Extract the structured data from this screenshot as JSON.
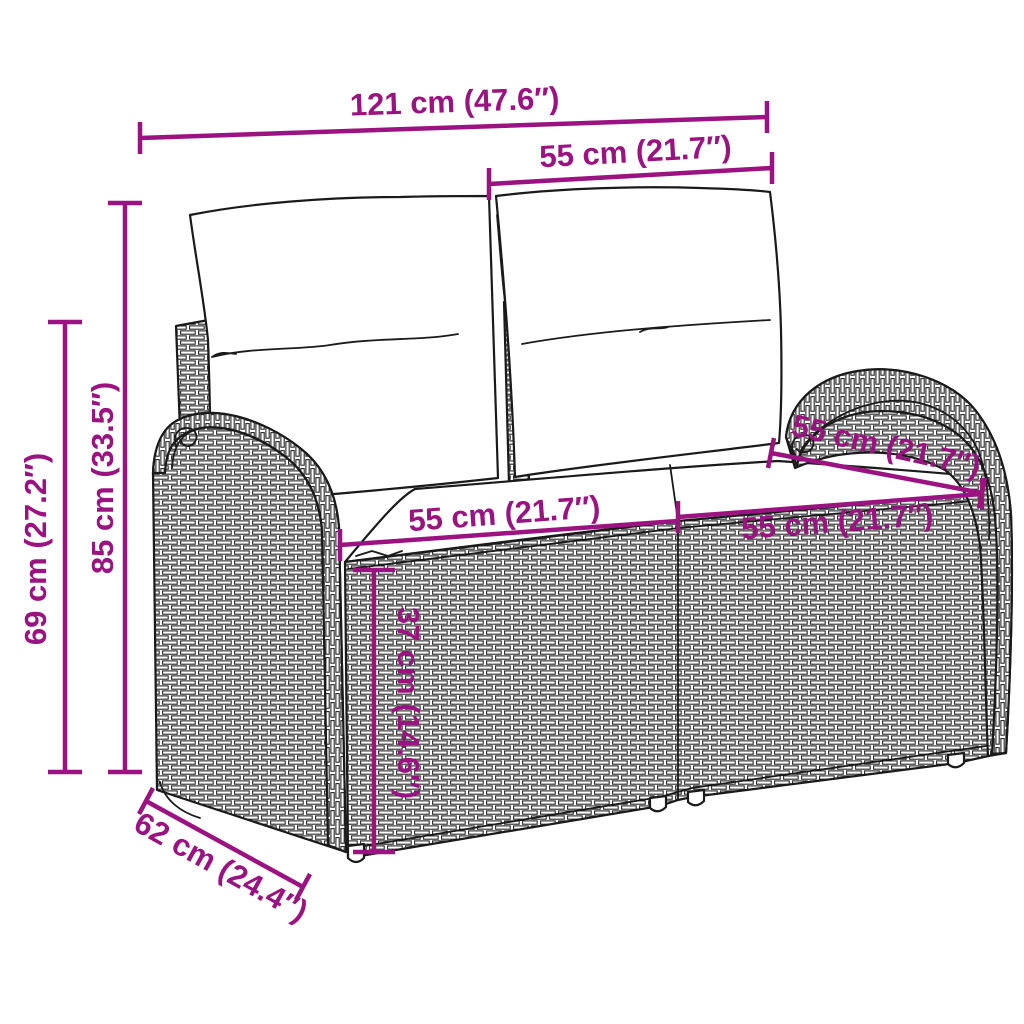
{
  "page": {
    "background": "#ffffff"
  },
  "diagram": {
    "subject": "poly-rattan-two-seater-garden-bench-with-cushions",
    "accent_color": "#9b1380",
    "line_color": "#1a1a1a",
    "dims": {
      "total_width": {
        "label": "121 cm (47.6″)",
        "value_cm": 121,
        "value_in": 47.6
      },
      "back_cushion_width": {
        "label": "55 cm (21.7″)",
        "value_cm": 55,
        "value_in": 21.7
      },
      "total_height": {
        "label": "85 cm (33.5″)",
        "value_cm": 85,
        "value_in": 33.5
      },
      "armrest_height": {
        "label": "69 cm (27.2″)",
        "value_cm": 69,
        "value_in": 27.2
      },
      "seat_depth_top": {
        "label": "55 cm (21.7″)",
        "value_cm": 55,
        "value_in": 21.7
      },
      "seat_width_left": {
        "label": "55 cm (21.7″)",
        "value_cm": 55,
        "value_in": 21.7
      },
      "seat_width_right": {
        "label": "55 cm (21.7″)",
        "value_cm": 55,
        "value_in": 21.7
      },
      "seat_height": {
        "label": "37 cm (14.6″)",
        "value_cm": 37,
        "value_in": 14.6
      },
      "base_depth": {
        "label": "62 cm (24.4″)",
        "value_cm": 62,
        "value_in": 24.4
      }
    }
  }
}
